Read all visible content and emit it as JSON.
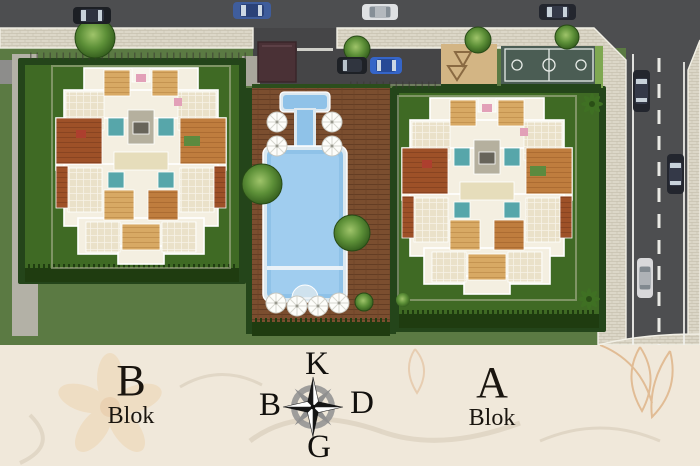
{
  "blocks": {
    "b": {
      "letter": "B",
      "word": "Blok"
    },
    "a": {
      "letter": "A",
      "word": "Blok"
    }
  },
  "compass": {
    "north": "K",
    "south": "G",
    "west": "B",
    "east": "D"
  },
  "site_features": {
    "pool": "swimming-pool",
    "pool_deck": "wooden-deck",
    "court": "basketball-court",
    "playground": "playground",
    "entrance": "entrance-canopy",
    "roads": [
      "top-road",
      "right-road"
    ],
    "cars_visible": 9,
    "umbrellas_visible": 8
  },
  "colors": {
    "band_background": "#f0e8da",
    "grass": "#5b7a43",
    "plot_lawn": "#3f6a24",
    "hedge": "#24451a",
    "road": "#4d4e50",
    "sidewalk": "#dcd7c8",
    "pool_water": "#8fc2e8",
    "deck_wood": "#7b4e2f",
    "court_surface": "#4b5d54",
    "label_text": "#1a150f"
  }
}
